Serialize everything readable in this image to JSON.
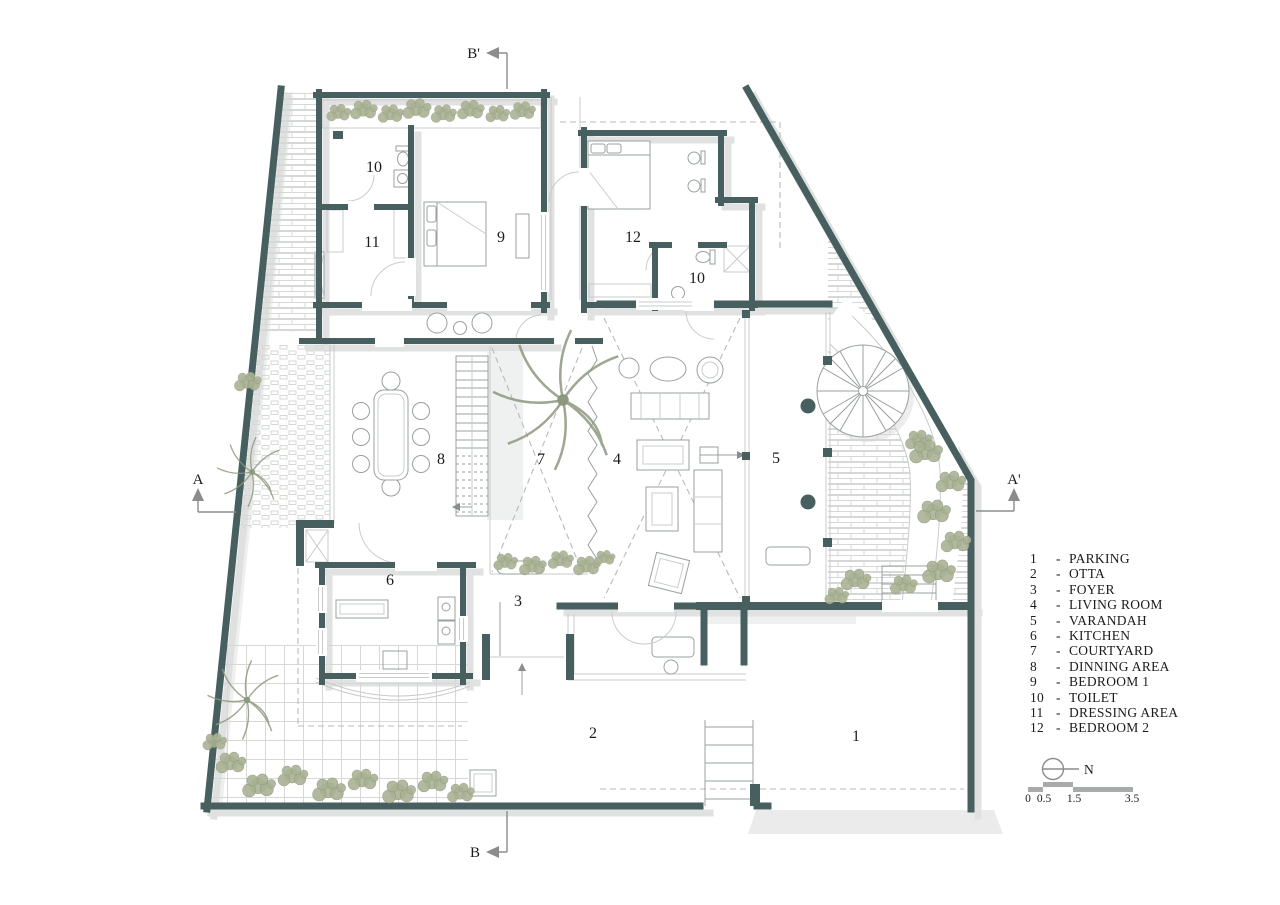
{
  "colors": {
    "wall": "#47605f",
    "shadow": "#d6d8d7",
    "green": "#aab294",
    "green_dark": "#8d987e",
    "line": "#9aa09e",
    "light_line": "#c9cccb",
    "dash": "#b7bab8",
    "text": "#1b1b1b",
    "marker": "#8a8d8c",
    "scale_bar": "#a8abaa"
  },
  "section_markers": {
    "top": "B'",
    "bottom": "B",
    "left": "A",
    "right": "A'"
  },
  "north_label": "N",
  "scale_bar": {
    "labels": [
      "0",
      "0.5",
      "1.5",
      "3.5"
    ]
  },
  "room_labels": [
    {
      "id": "toilet-1",
      "n": "10"
    },
    {
      "id": "dressing-area",
      "n": "11"
    },
    {
      "id": "bedroom-1",
      "n": "9"
    },
    {
      "id": "bedroom-2",
      "n": "12"
    },
    {
      "id": "toilet-2",
      "n": "10"
    },
    {
      "id": "dinning-area",
      "n": "8"
    },
    {
      "id": "courtyard",
      "n": "7"
    },
    {
      "id": "living-room",
      "n": "4"
    },
    {
      "id": "varandah",
      "n": "5"
    },
    {
      "id": "kitchen",
      "n": "6"
    },
    {
      "id": "foyer",
      "n": "3"
    },
    {
      "id": "otta",
      "n": "2"
    },
    {
      "id": "parking",
      "n": "1"
    }
  ],
  "legend": {
    "separator": "-",
    "items": [
      {
        "number": "1",
        "label": "PARKING"
      },
      {
        "number": "2",
        "label": "OTTA"
      },
      {
        "number": "3",
        "label": "FOYER"
      },
      {
        "number": "4",
        "label": "LIVING ROOM"
      },
      {
        "number": "5",
        "label": "VARANDAH"
      },
      {
        "number": "6",
        "label": "KITCHEN"
      },
      {
        "number": "7",
        "label": "COURTYARD"
      },
      {
        "number": "8",
        "label": "DINNING AREA"
      },
      {
        "number": "9",
        "label": "BEDROOM 1"
      },
      {
        "number": "10",
        "label": "TOILET"
      },
      {
        "number": "11",
        "label": "DRESSING AREA"
      },
      {
        "number": "12",
        "label": "BEDROOM 2"
      }
    ]
  }
}
